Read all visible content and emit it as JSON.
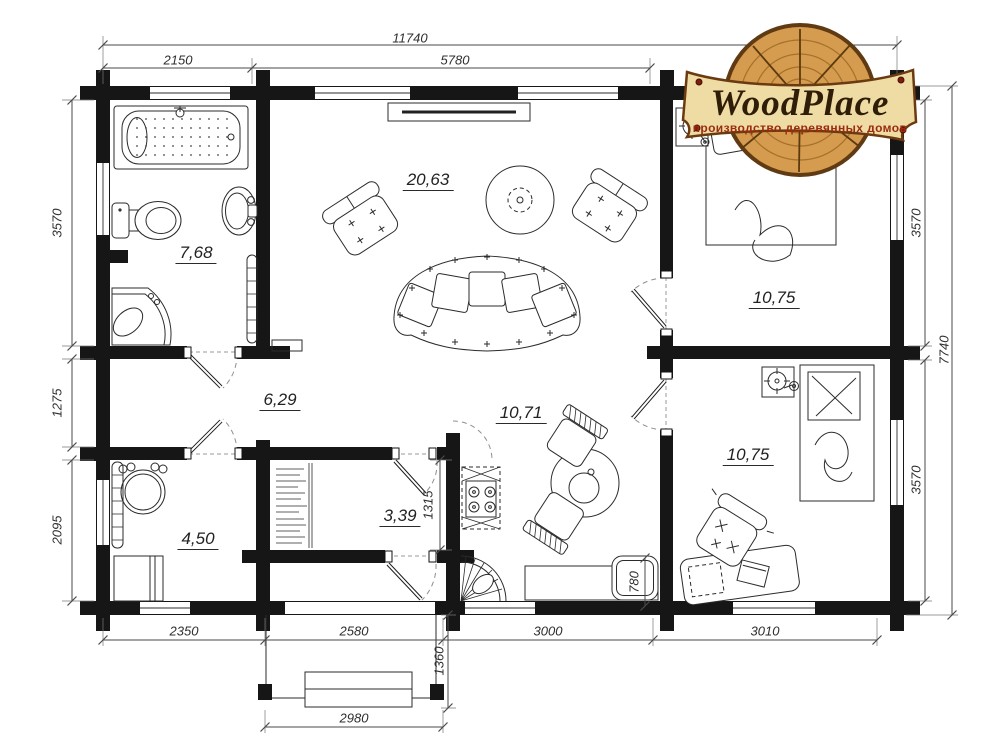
{
  "logo": {
    "title": "WoodPlace",
    "subtitle": "производство деревянных домов"
  },
  "dimensions": {
    "top_total": "11740",
    "top_left": "2150",
    "top_mid": "5780",
    "left_top": "3570",
    "left_mid": "1275",
    "left_bottom": "2095",
    "right_top": "3570",
    "right_bottom": "3570",
    "right_total": "7740",
    "bottom_1": "2350",
    "bottom_2": "2580",
    "bottom_3": "3000",
    "bottom_4": "3010",
    "porch_width": "2980",
    "porch_depth": "1360",
    "vestibule_depth": "780",
    "entry_depth": "1315"
  },
  "rooms": {
    "living": "20,63",
    "bathroom": "7,68",
    "hall": "6,29",
    "kitchen": "10,71",
    "entry": "3,39",
    "utility": "4,50",
    "bedroom1": "10,75",
    "bedroom2": "10,75"
  },
  "colors": {
    "wall": "#161616",
    "line": "#2b2b2b",
    "dim": "#4a4a4a",
    "arc": "#8f8f8f",
    "wood": "#d59b4e",
    "wood_ring": "#9c6a25",
    "wood_crack": "#5c3a10",
    "banner": "#eedca4",
    "banner_border": "#6b3a10",
    "logo_text": "#2f1d08",
    "logo_subtitle": "#9b2c10"
  }
}
